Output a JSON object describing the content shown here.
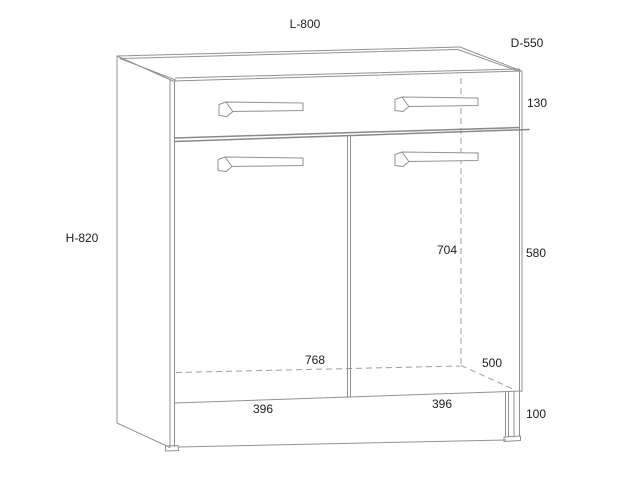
{
  "diagram": {
    "labels": {
      "overall_width": "L-800",
      "overall_depth": "D-550",
      "overall_height": "H-820",
      "drawer_front_height": "130",
      "door_panel_height": "580",
      "interior_height": "704",
      "interior_width": "768",
      "interior_depth": "500",
      "left_door_width": "396",
      "right_door_width": "396",
      "leg_height": "100"
    },
    "colors": {
      "background": "#ffffff",
      "line": "#8e9294",
      "hidden_line": "#9aa0a2",
      "text": "#1c1c1c"
    }
  }
}
